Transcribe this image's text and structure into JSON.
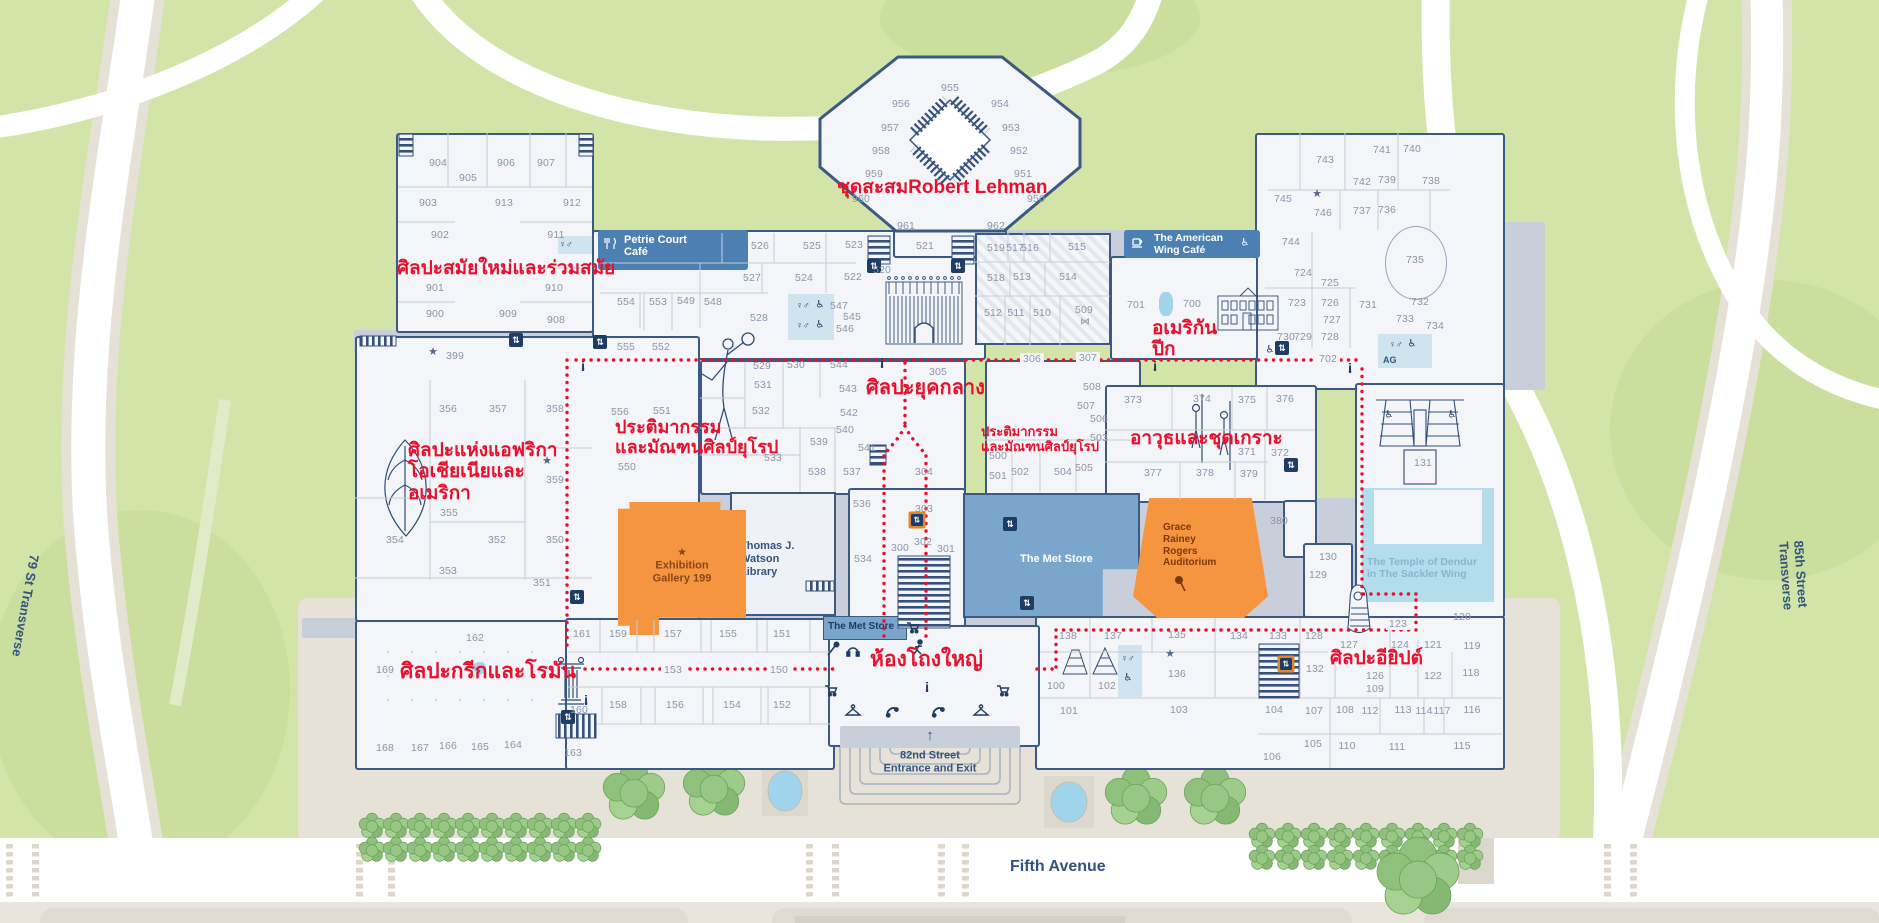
{
  "colors": {
    "red": "#e8112d",
    "navy": "#2e4d78",
    "wall": "#3b5a83",
    "orange": "#f6953f",
    "store_blue": "#7ba6cc",
    "banner_blue": "#4c80b2",
    "park": "#d3e4a8",
    "water": "#a9d7ea"
  },
  "streets": {
    "fifth": "Fifth Avenue",
    "t79": "79 St Transverse",
    "t85": "85th Street Transverse"
  },
  "entrance": {
    "arrow": "↑",
    "line1": "82nd Street",
    "line2": "Entrance and Exit"
  },
  "facilities": {
    "petrie": [
      "Petrie Court",
      "Café"
    ],
    "amcafe": [
      "The American",
      "Wing Café"
    ],
    "store_big": "The Met Store",
    "store_small": "The Met Store",
    "watson": [
      "Thomas J. Watson",
      "Library"
    ],
    "exhibition": [
      "Exhibition",
      "Gallery 199"
    ],
    "auditorium": [
      "Grace",
      "Rainey",
      "Rogers",
      "Auditorium"
    ],
    "dendur": [
      "The Temple of Dendur",
      "in The Sackler Wing"
    ],
    "ag": "AG"
  },
  "icon_glyphs": {
    "elevator-icon": "⇅",
    "info-icon": "i",
    "star-icon": "★",
    "wheelchair-icon": "♿",
    "restroom-icon": "♀♂",
    "arrow-up-icon": "↑",
    "bowtie-icon": "⋈"
  },
  "annotations": [
    {
      "lines": [
        "ศิลปะสมัยใหม่และร่วมสมัย"
      ],
      "x": 397,
      "y": 258,
      "s": 19
    },
    {
      "lines": [
        "ชุดสะสมRobert Lehman"
      ],
      "x": 837,
      "y": 177,
      "s": 19
    },
    {
      "lines": [
        "อเมริกัน",
        "ปีก"
      ],
      "x": 1152,
      "y": 318,
      "s": 19
    },
    {
      "lines": [
        "ประติมากรรม",
        "และมัณฑนศิลป์ยุโรป"
      ],
      "x": 615,
      "y": 417,
      "s": 18
    },
    {
      "lines": [
        "ศิลปะยุคกลาง"
      ],
      "x": 866,
      "y": 377,
      "s": 20
    },
    {
      "lines": [
        "ประติมากรรม",
        "และมัณฑนศิลป์ยุโรป"
      ],
      "x": 981,
      "y": 425,
      "s": 13
    },
    {
      "lines": [
        "อาวุธและชุดเกราะ"
      ],
      "x": 1130,
      "y": 428,
      "s": 19
    },
    {
      "lines": [
        "ศิลปะแห่งแอฟริกา",
        "โอเชียเนียและ",
        "อเมริกา"
      ],
      "x": 408,
      "y": 440,
      "s": 19
    },
    {
      "lines": [
        "ศิลปะกรีกและโรมัน"
      ],
      "x": 400,
      "y": 660,
      "s": 21
    },
    {
      "lines": [
        "ห้องโถงใหญ่"
      ],
      "x": 870,
      "y": 648,
      "s": 21
    },
    {
      "lines": [
        "ศิลปะอียิปต์"
      ],
      "x": 1330,
      "y": 648,
      "s": 19
    }
  ],
  "rooms": [
    [
      "904",
      438,
      163
    ],
    [
      "905",
      468,
      178
    ],
    [
      "906",
      506,
      163
    ],
    [
      "907",
      546,
      163
    ],
    [
      "903",
      428,
      203
    ],
    [
      "913",
      504,
      203
    ],
    [
      "912",
      572,
      203
    ],
    [
      "902",
      440,
      235
    ],
    [
      "911",
      556,
      235
    ],
    [
      "901",
      435,
      288
    ],
    [
      "910",
      554,
      288
    ],
    [
      "900",
      435,
      314
    ],
    [
      "909",
      508,
      314
    ],
    [
      "908",
      556,
      320
    ],
    [
      "399",
      455,
      356
    ],
    [
      "955",
      950,
      88
    ],
    [
      "956",
      901,
      104
    ],
    [
      "954",
      1000,
      104
    ],
    [
      "957",
      890,
      128
    ],
    [
      "953",
      1011,
      128
    ],
    [
      "958",
      881,
      151
    ],
    [
      "952",
      1019,
      151
    ],
    [
      "959",
      874,
      174
    ],
    [
      "951",
      1023,
      174
    ],
    [
      "960",
      861,
      199
    ],
    [
      "950",
      1036,
      199
    ],
    [
      "961",
      906,
      226
    ],
    [
      "962",
      996,
      226
    ],
    [
      "526",
      760,
      246
    ],
    [
      "525",
      812,
      246
    ],
    [
      "523",
      854,
      245
    ],
    [
      "520",
      882,
      270
    ],
    [
      "521",
      925,
      246
    ],
    [
      "527",
      752,
      278
    ],
    [
      "524",
      804,
      278
    ],
    [
      "522",
      853,
      277
    ],
    [
      "528",
      759,
      318
    ],
    [
      "547",
      839,
      306
    ],
    [
      "545",
      852,
      317
    ],
    [
      "546",
      845,
      329
    ],
    [
      "554",
      626,
      302
    ],
    [
      "553",
      658,
      302
    ],
    [
      "549",
      686,
      301
    ],
    [
      "548",
      713,
      302
    ],
    [
      "555",
      626,
      347
    ],
    [
      "552",
      661,
      347
    ],
    [
      "556",
      620,
      412
    ],
    [
      "551",
      662,
      411
    ],
    [
      "550",
      627,
      467
    ],
    [
      "519",
      996,
      248
    ],
    [
      "517",
      1015,
      248
    ],
    [
      "516",
      1030,
      248
    ],
    [
      "515",
      1077,
      247
    ],
    [
      "518",
      996,
      278
    ],
    [
      "513",
      1022,
      277
    ],
    [
      "514",
      1068,
      277
    ],
    [
      "512",
      993,
      313
    ],
    [
      "511",
      1016,
      313
    ],
    [
      "510",
      1042,
      313
    ],
    [
      "509",
      1084,
      310
    ],
    [
      "743",
      1325,
      160
    ],
    [
      "741",
      1382,
      150
    ],
    [
      "740",
      1412,
      149
    ],
    [
      "745",
      1283,
      199
    ],
    [
      "746",
      1323,
      213
    ],
    [
      "742",
      1362,
      182
    ],
    [
      "739",
      1387,
      180
    ],
    [
      "738",
      1431,
      181
    ],
    [
      "737",
      1362,
      211
    ],
    [
      "736",
      1387,
      210
    ],
    [
      "744",
      1291,
      242
    ],
    [
      "735",
      1415,
      260
    ],
    [
      "724",
      1303,
      273
    ],
    [
      "725",
      1330,
      283
    ],
    [
      "723",
      1297,
      303
    ],
    [
      "726",
      1330,
      303
    ],
    [
      "731",
      1368,
      305
    ],
    [
      "732",
      1420,
      302
    ],
    [
      "727",
      1332,
      320
    ],
    [
      "733",
      1405,
      319
    ],
    [
      "734",
      1435,
      326
    ],
    [
      "730",
      1286,
      337
    ],
    [
      "729",
      1303,
      337
    ],
    [
      "728",
      1330,
      337
    ],
    [
      "700",
      1192,
      304
    ],
    [
      "701",
      1136,
      305
    ],
    [
      "702",
      1328,
      359,
      1
    ],
    [
      "306",
      1032,
      359,
      1
    ],
    [
      "307",
      1088,
      358,
      1
    ],
    [
      "373",
      1133,
      400
    ],
    [
      "374",
      1202,
      399
    ],
    [
      "375",
      1247,
      400
    ],
    [
      "376",
      1285,
      399
    ],
    [
      "371",
      1247,
      452
    ],
    [
      "372",
      1280,
      453
    ],
    [
      "377",
      1153,
      473
    ],
    [
      "378",
      1205,
      473
    ],
    [
      "379",
      1249,
      474
    ],
    [
      "380",
      1279,
      521
    ],
    [
      "130",
      1328,
      557
    ],
    [
      "129",
      1318,
      575
    ],
    [
      "131",
      1423,
      463
    ],
    [
      "529",
      762,
      366
    ],
    [
      "530",
      796,
      365
    ],
    [
      "544",
      839,
      365
    ],
    [
      "305",
      938,
      372
    ],
    [
      "531",
      763,
      385
    ],
    [
      "543",
      848,
      389
    ],
    [
      "532",
      761,
      411
    ],
    [
      "542",
      849,
      413
    ],
    [
      "540",
      845,
      430
    ],
    [
      "539",
      819,
      442
    ],
    [
      "541",
      867,
      448
    ],
    [
      "533",
      773,
      458
    ],
    [
      "538",
      817,
      472
    ],
    [
      "537",
      852,
      472
    ],
    [
      "304",
      924,
      472
    ],
    [
      "536",
      862,
      504
    ],
    [
      "303",
      924,
      509
    ],
    [
      "302",
      923,
      542
    ],
    [
      "300",
      900,
      548
    ],
    [
      "301",
      946,
      549
    ],
    [
      "534",
      863,
      559
    ],
    [
      "508",
      1092,
      387
    ],
    [
      "507",
      1086,
      406
    ],
    [
      "506",
      1099,
      419
    ],
    [
      "503",
      1099,
      438
    ],
    [
      "500",
      998,
      456
    ],
    [
      "501",
      998,
      476
    ],
    [
      "502",
      1020,
      472
    ],
    [
      "504",
      1063,
      472
    ],
    [
      "505",
      1084,
      468
    ],
    [
      "356",
      448,
      409
    ],
    [
      "357",
      498,
      409
    ],
    [
      "358",
      555,
      409
    ],
    [
      "359",
      555,
      480
    ],
    [
      "355",
      449,
      513
    ],
    [
      "354",
      395,
      540
    ],
    [
      "352",
      497,
      540
    ],
    [
      "350",
      555,
      540
    ],
    [
      "353",
      448,
      571
    ],
    [
      "351",
      542,
      583
    ],
    [
      "162",
      475,
      638
    ],
    [
      "169",
      385,
      670
    ],
    [
      "168",
      385,
      748
    ],
    [
      "167",
      420,
      748
    ],
    [
      "166",
      448,
      746
    ],
    [
      "165",
      480,
      747
    ],
    [
      "164",
      513,
      745
    ],
    [
      "163",
      573,
      753
    ],
    [
      "161",
      582,
      634
    ],
    [
      "159",
      618,
      634
    ],
    [
      "157",
      673,
      634
    ],
    [
      "155",
      728,
      634
    ],
    [
      "151",
      782,
      634
    ],
    [
      "153",
      673,
      670,
      1
    ],
    [
      "150",
      779,
      670,
      1
    ],
    [
      "158",
      618,
      705
    ],
    [
      "156",
      675,
      705
    ],
    [
      "154",
      732,
      705
    ],
    [
      "152",
      782,
      705
    ],
    [
      "160",
      579,
      710
    ],
    [
      "138",
      1068,
      636
    ],
    [
      "137",
      1113,
      636
    ],
    [
      "135",
      1177,
      635
    ],
    [
      "136",
      1177,
      674
    ],
    [
      "134",
      1239,
      636
    ],
    [
      "133",
      1278,
      636
    ],
    [
      "128",
      1314,
      636
    ],
    [
      "132",
      1315,
      669
    ],
    [
      "127",
      1349,
      645
    ],
    [
      "124",
      1400,
      645
    ],
    [
      "121",
      1433,
      645
    ],
    [
      "119",
      1472,
      646
    ],
    [
      "126",
      1375,
      676
    ],
    [
      "122",
      1433,
      676
    ],
    [
      "118",
      1471,
      673
    ],
    [
      "123",
      1398,
      624,
      1
    ],
    [
      "120",
      1462,
      617
    ],
    [
      "100",
      1056,
      686
    ],
    [
      "102",
      1107,
      686
    ],
    [
      "101",
      1069,
      711
    ],
    [
      "103",
      1179,
      710
    ],
    [
      "104",
      1274,
      710
    ],
    [
      "107",
      1314,
      711
    ],
    [
      "108",
      1345,
      710
    ],
    [
      "112",
      1370,
      711
    ],
    [
      "113",
      1403,
      710
    ],
    [
      "114",
      1424,
      711
    ],
    [
      "117",
      1442,
      711
    ],
    [
      "116",
      1472,
      710
    ],
    [
      "109",
      1375,
      689
    ],
    [
      "105",
      1313,
      744
    ],
    [
      "110",
      1347,
      746
    ],
    [
      "111",
      1397,
      747
    ],
    [
      "115",
      1462,
      746
    ],
    [
      "106",
      1272,
      757
    ]
  ]
}
